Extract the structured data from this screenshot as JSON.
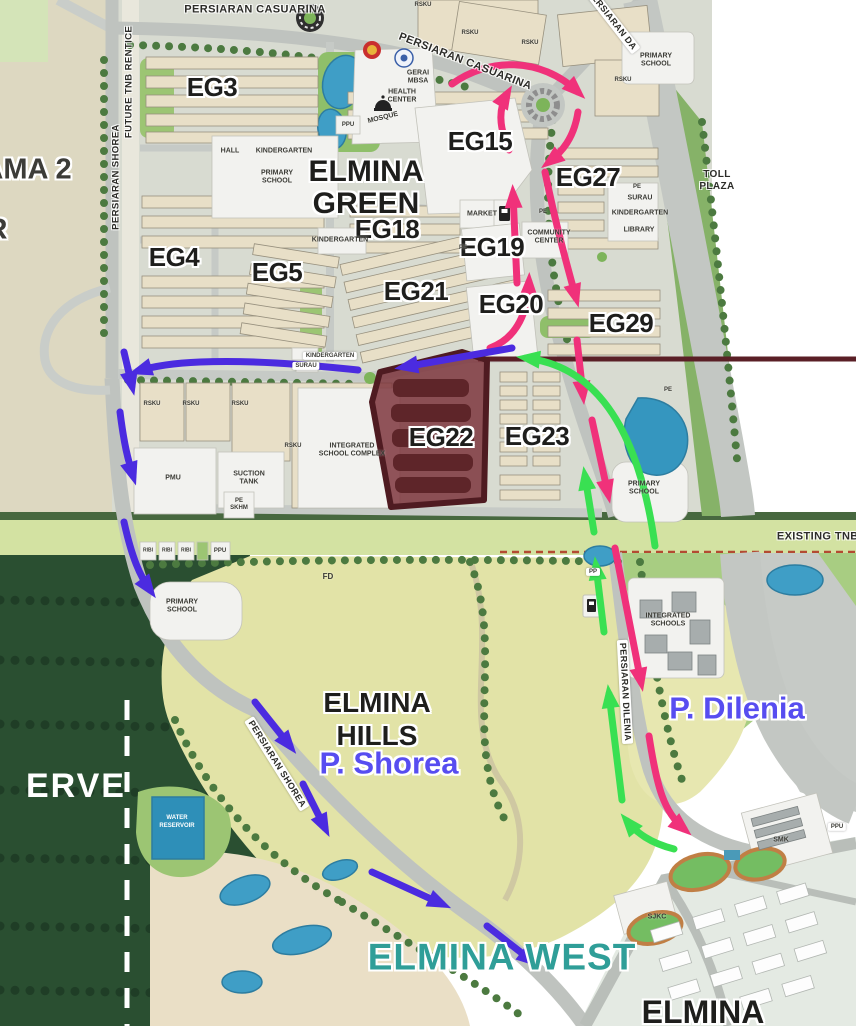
{
  "areas": {
    "elmina_green_line1": "ELMINA",
    "elmina_green_line2": "GREEN",
    "elmina_hills_line1": "ELMINA",
    "elmina_hills_line2": "HILLS",
    "p_shorea": "P. Shorea",
    "p_dilenia": "P. Dilenia",
    "elmina_west": "ELMINA WEST",
    "elmina": "ELMINA",
    "ama2": "AMA 2",
    "r_partial": "R",
    "reserve_partial": "ERVE"
  },
  "zones": {
    "eg3": "EG3",
    "eg4": "EG4",
    "eg5": "EG5",
    "eg15": "EG15",
    "eg18": "EG18",
    "eg19": "EG19",
    "eg20": "EG20",
    "eg21": "EG21",
    "eg22": "EG22",
    "eg23": "EG23",
    "eg27": "EG27",
    "eg29": "EG29"
  },
  "roads": {
    "persiaran_casuarina": "PERSIARAN CASUARINA",
    "future_tnb_rentice": "FUTURE TNB RENTICE",
    "persiaran_shorea": "PERSIARAN SHOREA",
    "persiaran_dilenia": "PERSIARAN DILENIA",
    "persiaran_d": "PERSIARAN DA",
    "existing_tnb_rentice": "EXISTING TNB RENTICE",
    "toll_plaza_line1": "TOLL",
    "toll_plaza_line2": "PLAZA"
  },
  "facilities": {
    "hall": "HALL",
    "kindergarten": "KINDERGARTEN",
    "primary_line1": "PRIMARY",
    "primary_line2": "SCHOOL",
    "gerai_line1": "GERAI",
    "gerai_line2": "MBSA",
    "health_line1": "HEALTH",
    "health_line2": "CENTER",
    "mosque": "MOSQUE",
    "ppu": "PPU",
    "pmu": "PMU",
    "pp": "PP",
    "pe": "PE",
    "rsku": "RSKU",
    "ribi": "RIBI",
    "market": "MARKET",
    "community_line1": "COMMUNITY",
    "community_line2": "CENTER",
    "surau": "SURAU",
    "library": "LIBRARY",
    "isc_line1": "INTEGRATED",
    "isc_line2": "SCHOOL COMPLEX",
    "ischools_line1": "INTEGRATED",
    "ischools_line2": "SCHOOLS",
    "suction_line1": "SUCTION",
    "suction_line2": "TANK",
    "pe_skhm_line1": "PE",
    "pe_skhm_line2": "SKHM",
    "fd": "FD",
    "water_line1": "WATER",
    "water_line2": "RESERVOIR",
    "smk": "SMK",
    "sjkc": "SJKC"
  },
  "colors": {
    "highlight_zone_fill": "#7a3038",
    "highlight_outline": "#4f1b21",
    "callout_line": "#5a1f26",
    "arrow_pink": "#f0317a",
    "arrow_green": "#39e052",
    "arrow_blue": "#4b2be0",
    "label_purple": "#574df0",
    "label_teal": "#2f9e98",
    "pond_blue": "#3f9ec6",
    "forest_green": "#2a4f31",
    "hills_yellow": "#e2e3a7"
  }
}
